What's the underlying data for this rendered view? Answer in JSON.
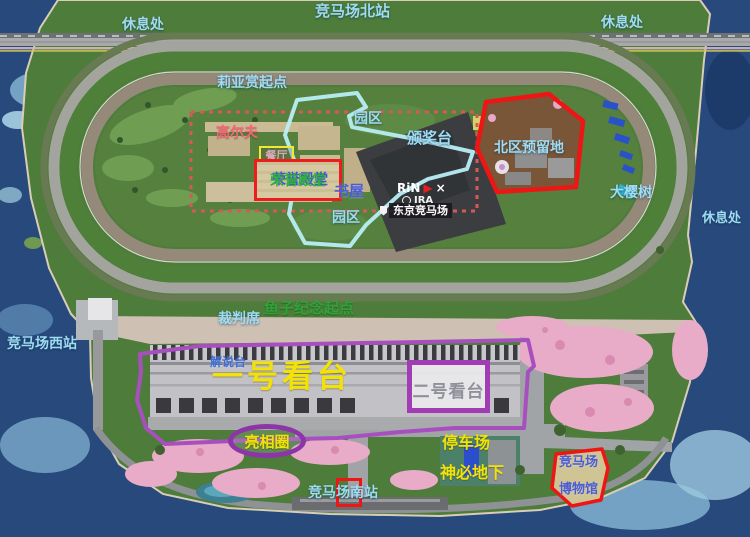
{
  "map": {
    "colors": {
      "water": "#27497c",
      "water_shallow": "#8fc0dc",
      "land_green": "#4e7c3a",
      "track_turf": "#4e8039",
      "track_dirt": "#95897a",
      "annotation_red": "#ee1515",
      "annotation_cyan": "#b8eef6",
      "annotation_purple": "#a23cb4",
      "annotation_dashed_pink": "#d45a5a",
      "label_lightblue": "#9fdcf2",
      "label_yellow": "#f2e205",
      "label_green": "#2fa33a",
      "label_pink_red": "#f26876",
      "label_blue": "#4a5cd8",
      "label_gray": "#90909a"
    },
    "stations": {
      "north": "竞马场北站",
      "west": "竞马场西站",
      "south": "竞马场南站"
    },
    "rest_areas": {
      "top_left": "休息处",
      "top_right": "休息处",
      "right": "休息处"
    },
    "track": {
      "lia_start": "莉亚赏起点",
      "caviar_memorial_start": "鱼子纪念起点",
      "judges_stand": "裁判席"
    },
    "infield": {
      "golf": "高尔夫",
      "restaurant": "餐厅",
      "hall_of_fame": "荣誉殿堂",
      "book_house": "书屋",
      "park_upper": "园区",
      "park_lower": "园区",
      "award_podium": "颁奖台",
      "north_reserved": "北区预留地",
      "big_cherry_tree": "大樱树",
      "logo_rin": "RiN",
      "logo_times": "×",
      "logo_jra": "JRA",
      "marker_tokyo": "东京竞马场"
    },
    "south": {
      "commentary_stand": "解说台",
      "grandstand_1": "一号看台",
      "grandstand_2": "二号看台",
      "paddock": "亮相圈",
      "parking": "停车场",
      "mystery_underground": "神必地下",
      "museum_line1": "竞马场",
      "museum_line2": "博物馆"
    }
  }
}
